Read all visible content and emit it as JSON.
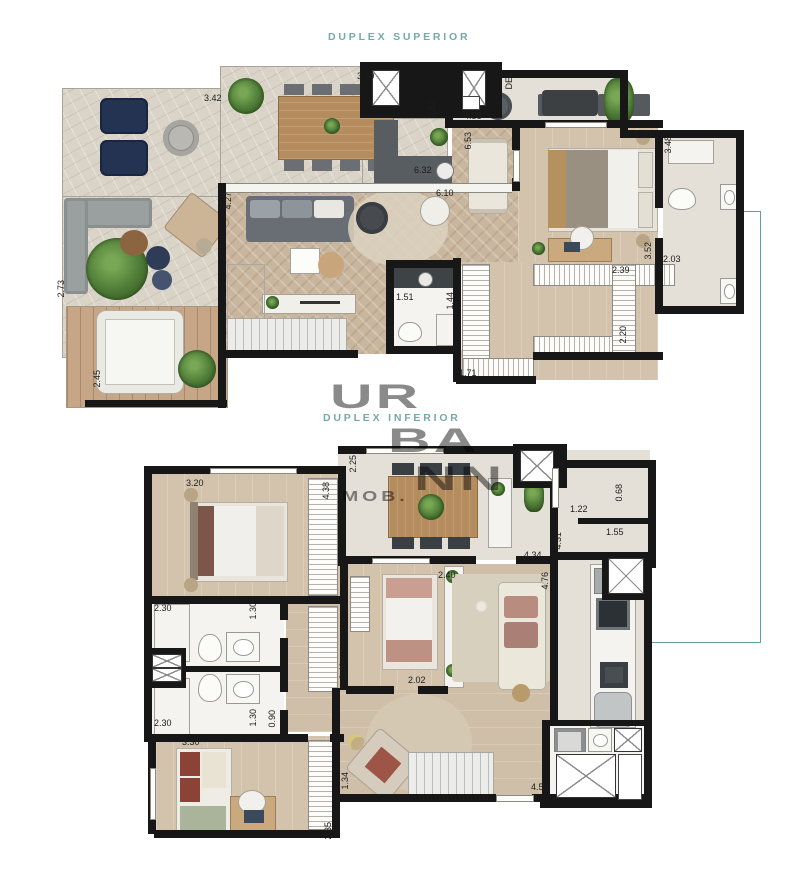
{
  "page": {
    "title_superior": "DUPLEX SUPERIOR",
    "title_inferior": "DUPLEX INFERIOR",
    "watermark": {
      "line1": "UR",
      "line2": "BA",
      "line3": "NN",
      "sub": "MOB."
    },
    "accent_color": "#74aaa8",
    "connector_color": "#5f9fa0",
    "wall_color": "#171717"
  },
  "upper_plan": {
    "name": "duplex-superior-floor-plan",
    "dimensions": [
      {
        "value": "3.42",
        "x": 204,
        "y": 94,
        "vert": false
      },
      {
        "value": "3.29",
        "x": 357,
        "y": 72,
        "vert": false
      },
      {
        "value": "2.12",
        "x": 428,
        "y": 100,
        "vert": true
      },
      {
        "value": "DEL",
        "x": 505,
        "y": 72,
        "vert": true
      },
      {
        "value": "4.58",
        "x": 464,
        "y": 112,
        "vert": false
      },
      {
        "value": "6.53",
        "x": 464,
        "y": 132,
        "vert": true
      },
      {
        "value": "5.00",
        "x": 634,
        "y": 130,
        "vert": false
      },
      {
        "value": "3.48",
        "x": 664,
        "y": 136,
        "vert": true
      },
      {
        "value": "6.32",
        "x": 414,
        "y": 166,
        "vert": false
      },
      {
        "value": "6.10",
        "x": 436,
        "y": 189,
        "vert": false
      },
      {
        "value": "4.27",
        "x": 224,
        "y": 192,
        "vert": true
      },
      {
        "value": "2.39",
        "x": 612,
        "y": 266,
        "vert": false
      },
      {
        "value": "2.20",
        "x": 619,
        "y": 326,
        "vert": true
      },
      {
        "value": "3.52",
        "x": 644,
        "y": 242,
        "vert": true
      },
      {
        "value": "2.03",
        "x": 663,
        "y": 255,
        "vert": false
      },
      {
        "value": "1.51",
        "x": 396,
        "y": 293,
        "vert": false
      },
      {
        "value": "1.44",
        "x": 446,
        "y": 292,
        "vert": true
      },
      {
        "value": "1.71",
        "x": 459,
        "y": 369,
        "vert": false
      },
      {
        "value": "2.73",
        "x": 57,
        "y": 280,
        "vert": true
      },
      {
        "value": "2.45",
        "x": 93,
        "y": 370,
        "vert": true
      }
    ]
  },
  "lower_plan": {
    "name": "duplex-inferior-floor-plan",
    "dimensions": [
      {
        "value": "2.25",
        "x": 349,
        "y": 455,
        "vert": true
      },
      {
        "value": "3.20",
        "x": 186,
        "y": 479,
        "vert": false
      },
      {
        "value": "4.38",
        "x": 322,
        "y": 482,
        "vert": true
      },
      {
        "value": "4.34",
        "x": 524,
        "y": 551,
        "vert": false
      },
      {
        "value": "4.31",
        "x": 554,
        "y": 532,
        "vert": true
      },
      {
        "value": "1.22",
        "x": 570,
        "y": 505,
        "vert": false
      },
      {
        "value": "0.68",
        "x": 615,
        "y": 484,
        "vert": true
      },
      {
        "value": "1.55",
        "x": 606,
        "y": 528,
        "vert": false
      },
      {
        "value": "2.40",
        "x": 438,
        "y": 571,
        "vert": false
      },
      {
        "value": "4.76",
        "x": 541,
        "y": 572,
        "vert": true
      },
      {
        "value": "2.40",
        "x": 339,
        "y": 662,
        "vert": true
      },
      {
        "value": "2.30",
        "x": 154,
        "y": 604,
        "vert": false
      },
      {
        "value": "1.30",
        "x": 249,
        "y": 602,
        "vert": true
      },
      {
        "value": "2.30",
        "x": 154,
        "y": 719,
        "vert": false
      },
      {
        "value": "1.30",
        "x": 249,
        "y": 709,
        "vert": true
      },
      {
        "value": "0.90",
        "x": 268,
        "y": 710,
        "vert": true
      },
      {
        "value": "3.30",
        "x": 182,
        "y": 738,
        "vert": false
      },
      {
        "value": "2.35",
        "x": 324,
        "y": 822,
        "vert": true
      },
      {
        "value": "1.34",
        "x": 341,
        "y": 772,
        "vert": true
      },
      {
        "value": "2.02",
        "x": 408,
        "y": 676,
        "vert": false
      },
      {
        "value": "4.53",
        "x": 531,
        "y": 783,
        "vert": false
      }
    ]
  }
}
